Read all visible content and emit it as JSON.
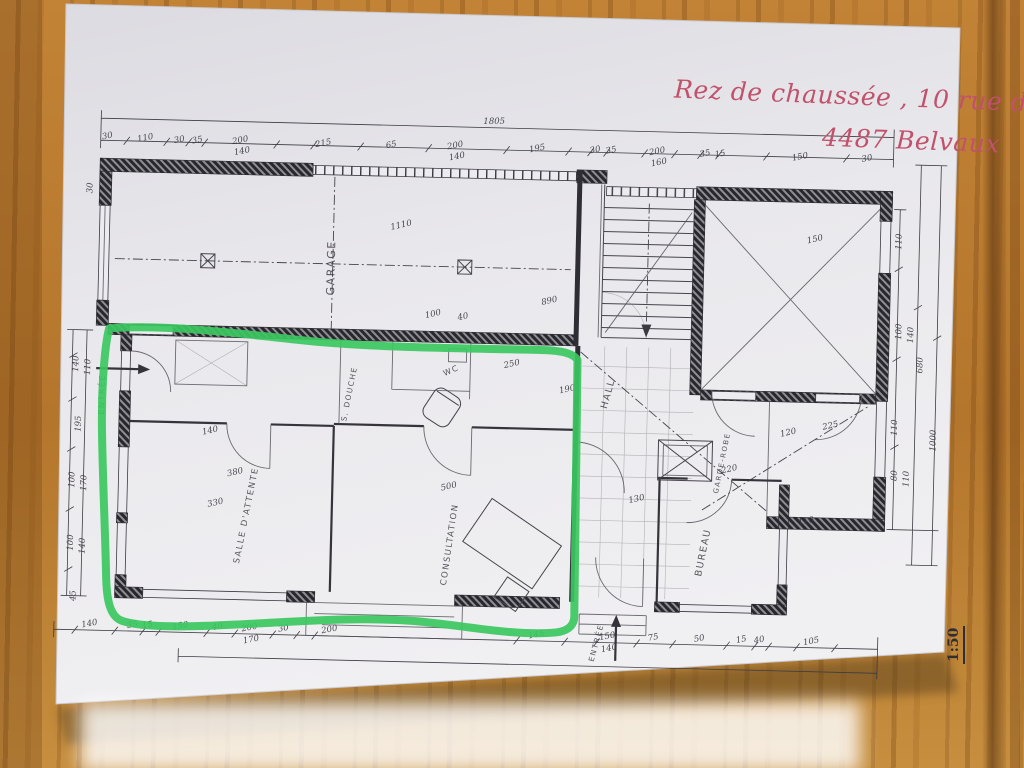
{
  "annotations": {
    "handwriting_line1": "Rez de chaussée , 10 rue de Soleuvre",
    "handwriting_line2": "4487 Belvaux",
    "scale_note": "1:50"
  },
  "colors": {
    "wood": "#b9792f",
    "paper": "#e9e8ec",
    "ink": "#3f3f47",
    "green_outline": "#3bc75f",
    "red_handwriting": "#c2516b"
  },
  "plan": {
    "room_labels": [
      {
        "t": "GARAGE",
        "x": 332,
        "y": 272,
        "r": -90,
        "s": 11
      },
      {
        "t": "ENTRÉE",
        "x": 105,
        "y": 404,
        "r": -90,
        "s": 8
      },
      {
        "t": "S. DOUCHE",
        "x": 352,
        "y": 398,
        "r": -80,
        "s": 7.5
      },
      {
        "t": "WC",
        "x": 452,
        "y": 374,
        "r": -25,
        "s": 8
      },
      {
        "t": "SALLE D'ATTENTE",
        "x": 252,
        "y": 522,
        "r": -80,
        "s": 8.5
      },
      {
        "t": "CONSULTATION",
        "x": 456,
        "y": 546,
        "r": -83,
        "s": 8.5
      },
      {
        "t": "HALL",
        "x": 611,
        "y": 392,
        "r": -76,
        "s": 9.5
      },
      {
        "t": "GARDE-ROBE",
        "x": 726,
        "y": 458,
        "r": -80,
        "s": 7
      },
      {
        "t": "BUREAU",
        "x": 710,
        "y": 548,
        "r": -80,
        "s": 9.5
      },
      {
        "t": "ENTRÉE",
        "x": 605,
        "y": 641,
        "r": -76,
        "s": 7.5
      }
    ],
    "dimension_labels": [
      {
        "t": "1805",
        "x": 488,
        "y": 124,
        "r": -2,
        "s": 11
      },
      {
        "t": "30",
        "x": 102,
        "y": 148,
        "r": -12
      },
      {
        "t": "110",
        "x": 140,
        "y": 149,
        "r": -12
      },
      {
        "t": "30",
        "x": 174,
        "y": 150,
        "r": -12
      },
      {
        "t": "35",
        "x": 192,
        "y": 150,
        "r": -12
      },
      {
        "t": "200",
        "x": 235,
        "y": 149,
        "r": -12
      },
      {
        "t": "140",
        "x": 237,
        "y": 160,
        "r": -12
      },
      {
        "t": "215",
        "x": 318,
        "y": 150,
        "r": -12
      },
      {
        "t": "65",
        "x": 386,
        "y": 150,
        "r": -12
      },
      {
        "t": "200",
        "x": 450,
        "y": 149,
        "r": -12
      },
      {
        "t": "140",
        "x": 452,
        "y": 160,
        "r": -12
      },
      {
        "t": "195",
        "x": 532,
        "y": 150,
        "r": -12
      },
      {
        "t": "30",
        "x": 590,
        "y": 150,
        "r": -12
      },
      {
        "t": "35",
        "x": 606,
        "y": 150,
        "r": -12
      },
      {
        "t": "200",
        "x": 652,
        "y": 150,
        "r": -12
      },
      {
        "t": "160",
        "x": 654,
        "y": 161,
        "r": -12
      },
      {
        "t": "35",
        "x": 700,
        "y": 151,
        "r": -12
      },
      {
        "t": "15",
        "x": 715,
        "y": 151,
        "r": -12
      },
      {
        "t": "150",
        "x": 795,
        "y": 152,
        "r": -12
      },
      {
        "t": "30",
        "x": 862,
        "y": 152,
        "r": -12
      },
      {
        "t": "140",
        "x": 96,
        "y": 636,
        "r": -12
      },
      {
        "t": "35",
        "x": 139,
        "y": 636,
        "r": -12
      },
      {
        "t": "15",
        "x": 154,
        "y": 636,
        "r": -12
      },
      {
        "t": "150",
        "x": 187,
        "y": 636,
        "r": -12
      },
      {
        "t": "40",
        "x": 224,
        "y": 636,
        "r": -12
      },
      {
        "t": "200",
        "x": 256,
        "y": 636,
        "r": -12
      },
      {
        "t": "170",
        "x": 258,
        "y": 648,
        "r": -12
      },
      {
        "t": "30",
        "x": 290,
        "y": 636,
        "r": -12
      },
      {
        "t": "200",
        "x": 336,
        "y": 636,
        "r": -12
      },
      {
        "t": "145",
        "x": 543,
        "y": 636,
        "r": -12
      },
      {
        "t": "150",
        "x": 614,
        "y": 636,
        "r": -12
      },
      {
        "t": "140",
        "x": 616,
        "y": 648,
        "r": -12
      },
      {
        "t": "75",
        "x": 660,
        "y": 636,
        "r": -12
      },
      {
        "t": "50",
        "x": 706,
        "y": 636,
        "r": -12
      },
      {
        "t": "15",
        "x": 748,
        "y": 636,
        "r": -12
      },
      {
        "t": "40",
        "x": 766,
        "y": 636,
        "r": -12
      },
      {
        "t": "105",
        "x": 818,
        "y": 636,
        "r": -12
      },
      {
        "t": "30",
        "x": 88,
        "y": 198,
        "r": -90
      },
      {
        "t": "140",
        "x": 78,
        "y": 374,
        "r": -90
      },
      {
        "t": "110",
        "x": 90,
        "y": 377,
        "r": -90
      },
      {
        "t": "195",
        "x": 82,
        "y": 434,
        "r": -90
      },
      {
        "t": "100",
        "x": 77,
        "y": 490,
        "r": -90
      },
      {
        "t": "170",
        "x": 89,
        "y": 493,
        "r": -90
      },
      {
        "t": "100",
        "x": 77,
        "y": 553,
        "r": -90
      },
      {
        "t": "140",
        "x": 89,
        "y": 556,
        "r": -90
      },
      {
        "t": "45",
        "x": 81,
        "y": 606,
        "r": -90
      },
      {
        "t": "110",
        "x": 898,
        "y": 232,
        "r": -90
      },
      {
        "t": "100",
        "x": 900,
        "y": 322,
        "r": -90
      },
      {
        "t": "140",
        "x": 912,
        "y": 325,
        "r": -90
      },
      {
        "t": "680",
        "x": 922,
        "y": 355,
        "r": -90
      },
      {
        "t": "110",
        "x": 898,
        "y": 418,
        "r": -90
      },
      {
        "t": "80",
        "x": 899,
        "y": 466,
        "r": -90
      },
      {
        "t": "110",
        "x": 911,
        "y": 469,
        "r": -90
      },
      {
        "t": "1000",
        "x": 937,
        "y": 430,
        "r": -90
      },
      {
        "t": "1110",
        "x": 398,
        "y": 230,
        "r": -14
      },
      {
        "t": "890",
        "x": 548,
        "y": 302,
        "r": -14
      },
      {
        "t": "100",
        "x": 432,
        "y": 318,
        "r": -14
      },
      {
        "t": "40",
        "x": 462,
        "y": 320,
        "r": -14
      },
      {
        "t": "250",
        "x": 512,
        "y": 366,
        "r": -14
      },
      {
        "t": "190",
        "x": 568,
        "y": 390,
        "r": -14
      },
      {
        "t": "150",
        "x": 812,
        "y": 234,
        "r": -14
      },
      {
        "t": "120",
        "x": 790,
        "y": 428,
        "r": -14
      },
      {
        "t": "225",
        "x": 832,
        "y": 420,
        "r": -14
      },
      {
        "t": "380",
        "x": 238,
        "y": 481,
        "r": -14
      },
      {
        "t": "330",
        "x": 219,
        "y": 512,
        "r": -14
      },
      {
        "t": "500",
        "x": 452,
        "y": 490,
        "r": -14
      },
      {
        "t": "140",
        "x": 212,
        "y": 440,
        "r": -14
      },
      {
        "t": "110",
        "x": 810,
        "y": 516,
        "r": -14
      },
      {
        "t": "220",
        "x": 732,
        "y": 466,
        "r": -14
      },
      {
        "t": "130",
        "x": 640,
        "y": 498,
        "r": -14
      }
    ]
  }
}
